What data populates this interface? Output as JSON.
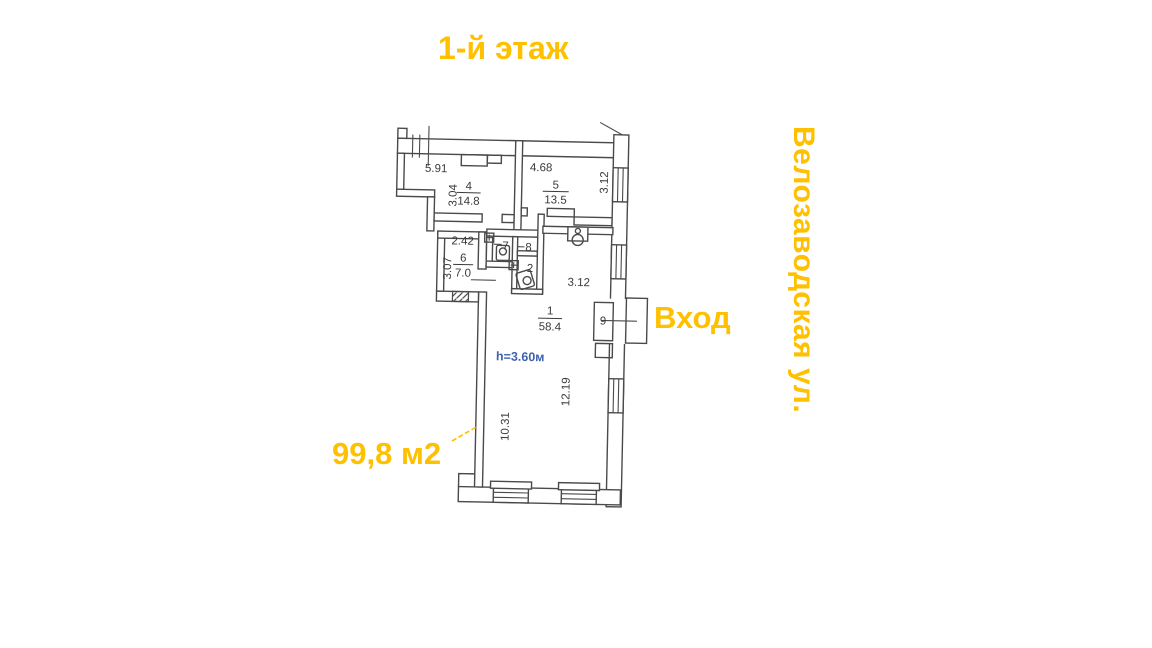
{
  "accent_color": "#FFC000",
  "title": "1-й этаж",
  "street_label": "Велозаводская ул.",
  "entrance_label": "Вход",
  "total_area_label": "99,8 м2",
  "plan": {
    "line_color": "#4a4a4a",
    "height_note": "h=3.60м",
    "height_note_color": "#3E62AD",
    "rooms": {
      "r1": {
        "number": "1",
        "area": "58.4",
        "dim_top": "3.12",
        "dim_right": "12.19",
        "dim_left": "10.31"
      },
      "r2": {
        "number": "2"
      },
      "r4": {
        "number": "4",
        "area": "14.8",
        "dim_top": "5.91",
        "dim_side": "3.04"
      },
      "r5": {
        "number": "5",
        "area": "13.5",
        "dim_top": "4.68",
        "dim_side": "3.12"
      },
      "r6": {
        "number": "6",
        "area": "7.0",
        "dim_top": "2.42",
        "dim_side": "3.07"
      },
      "r7": {
        "number": "7"
      },
      "r8": {
        "number": "8"
      },
      "r9": {
        "number": "9"
      }
    }
  }
}
